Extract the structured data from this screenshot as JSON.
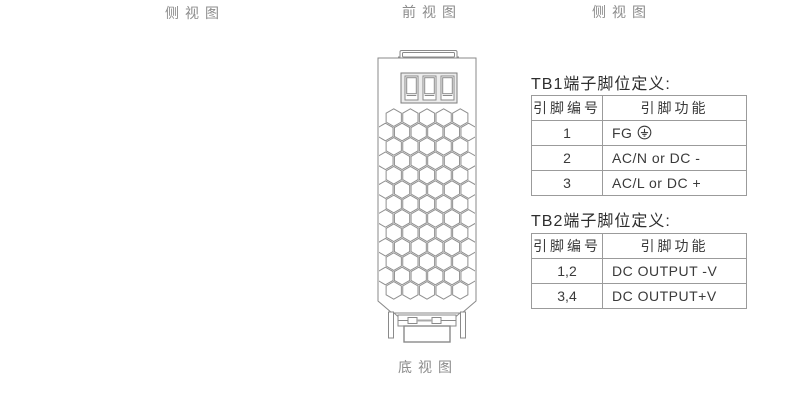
{
  "view_labels": {
    "side_left": "侧视图",
    "front": "前视图",
    "side_right": "侧视图",
    "bottom": "底视图"
  },
  "tb1": {
    "title": "TB1端子脚位定义:",
    "headers": [
      "引脚编号",
      "引脚功能"
    ],
    "rows": [
      {
        "pin": "1",
        "function": "FG",
        "has_ground_icon": true
      },
      {
        "pin": "2",
        "function": "AC/N or DC -",
        "has_ground_icon": false
      },
      {
        "pin": "3",
        "function": "AC/L  or DC +",
        "has_ground_icon": false
      }
    ]
  },
  "tb2": {
    "title": "TB2端子脚位定义:",
    "headers": [
      "引脚编号",
      "引脚功能"
    ],
    "rows": [
      {
        "pin": "1,2",
        "function": "DC OUTPUT -V"
      },
      {
        "pin": "3,4",
        "function": "DC OUTPUT+V"
      }
    ]
  },
  "icons": {
    "ground": "earth-ground"
  },
  "colors": {
    "line": "#8a8a8a",
    "table_border": "#9b9b9b",
    "text": "#3a3a3a",
    "label": "#8c8c8c",
    "title": "#2e2e2e"
  }
}
